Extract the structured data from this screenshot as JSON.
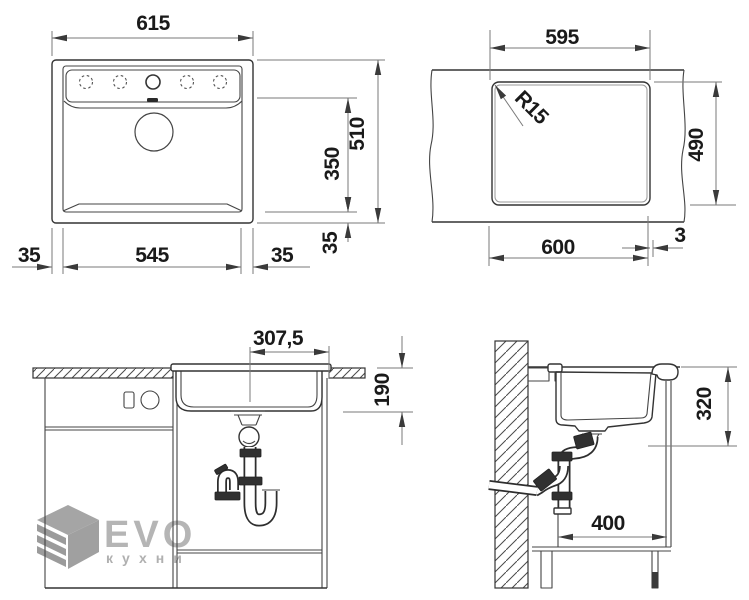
{
  "drawing": {
    "top_view": {
      "overall_width": "615",
      "bowl_width": "545",
      "margin_left": "35",
      "margin_right": "35",
      "overall_depth": "510",
      "bowl_depth": "350",
      "edge_offset": "35"
    },
    "cutout_view": {
      "cutout_width": "595",
      "corner_radius": "R15",
      "cutout_depth": "490",
      "base_width": "600",
      "edge_gap": "3"
    },
    "front_view": {
      "center_to_edge": "307,5",
      "bowl_height": "190"
    },
    "side_view": {
      "min_clearance": "320",
      "depth_clearance": "400"
    }
  },
  "watermark": {
    "brand": "EVO",
    "subtitle": "кухни"
  },
  "colors": {
    "object_line": "#333333",
    "dimension_line": "#7a7a7a",
    "text": "#1a1a1a",
    "watermark": "#b5b5b5"
  }
}
